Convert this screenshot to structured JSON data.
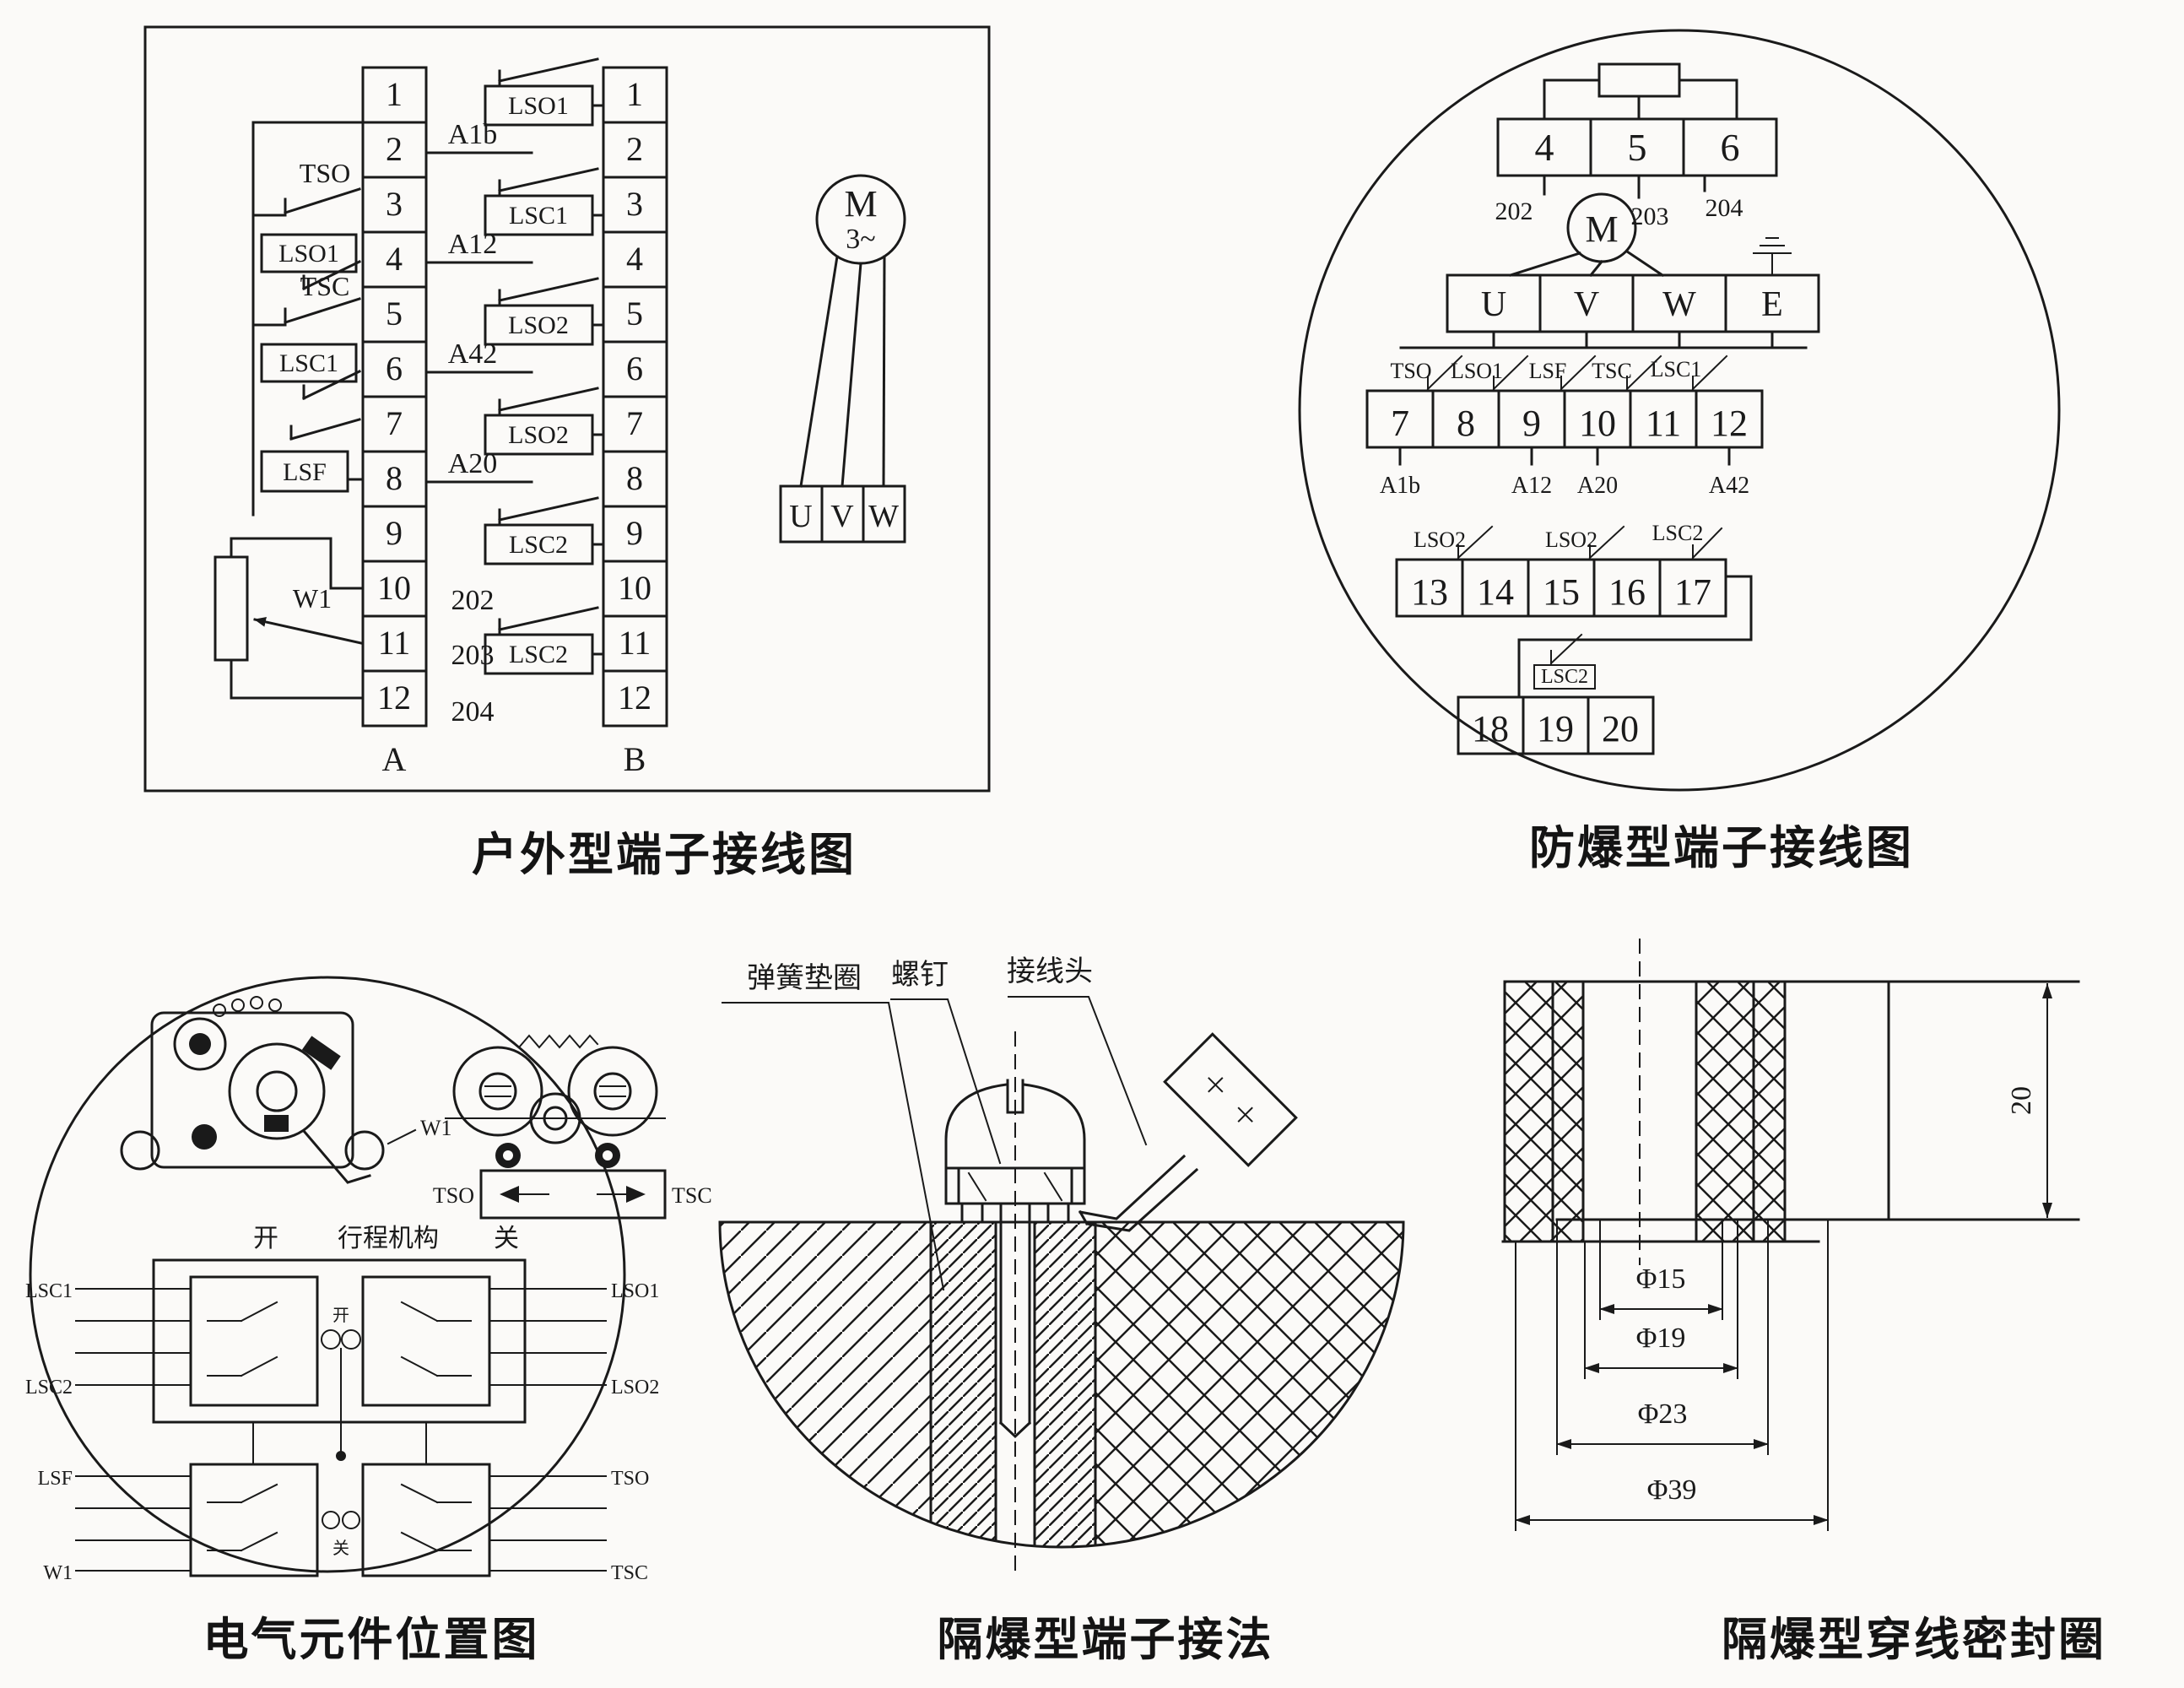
{
  "ink": "#1a1a1a",
  "bg": "#fbfaf8",
  "captions": {
    "outdoor": "户外型端子接线图",
    "explosion": "防爆型端子接线图",
    "components": "电气元件位置图",
    "terminal_method": "隔爆型端子接法",
    "seal_ring": "隔爆型穿线密封圈"
  },
  "outdoor": {
    "terminals": [
      "1",
      "2",
      "3",
      "4",
      "5",
      "6",
      "7",
      "8",
      "9",
      "10",
      "11",
      "12"
    ],
    "strip_a_label": "A",
    "strip_b_label": "B",
    "left_switches": {
      "tso": "TSO",
      "lso1": "LSO1",
      "tsc": "TSC",
      "lsc1": "LSC1",
      "lsf": "LSF"
    },
    "pot": "W1",
    "right_labels": {
      "a1b": "A1b",
      "a12": "A12",
      "a42": "A42",
      "a20": "A20",
      "n202": "202",
      "n203": "203",
      "n204": "204"
    },
    "b_switches": [
      "LSO1",
      "LSC1",
      "LSO2",
      "LSO2",
      "LSC2",
      "LSC2"
    ],
    "motor": {
      "m": "M",
      "phase": "3~",
      "u": "U",
      "v": "V",
      "w": "W"
    }
  },
  "explosion": {
    "row1": [
      "4",
      "5",
      "6"
    ],
    "row1_sub": [
      "202",
      "203",
      "204"
    ],
    "motor_m": "M",
    "row2": [
      "U",
      "V",
      "W",
      "E"
    ],
    "row3": [
      "7",
      "8",
      "9",
      "10",
      "11",
      "12"
    ],
    "row3_switches": [
      "TSO",
      "LSO1",
      "LSF",
      "TSC",
      "LSC1"
    ],
    "row3_sub": [
      "A1b",
      "A12",
      "A20",
      "A42"
    ],
    "row4": [
      "13",
      "14",
      "15",
      "16",
      "17"
    ],
    "row4_switches": [
      "LSO2",
      "LSO2",
      "LSC2"
    ],
    "row5": [
      "18",
      "19",
      "20"
    ],
    "row5_switch": "LSC2"
  },
  "components": {
    "pot_label": "W1",
    "torque_left": "TSO",
    "torque_right": "TSC",
    "row_open": "开",
    "row_mech": "行程机构",
    "row_close": "关",
    "g1_l1": "LSC1",
    "g1_l2": "LSC2",
    "g1_r1": "LSO1",
    "g1_r2": "LSO2",
    "g1_c": "开",
    "g2_l1": "LSF",
    "g2_l2": "W1",
    "g2_r1": "TSO",
    "g2_r2": "TSC",
    "g2_c": "关"
  },
  "method": {
    "washer": "弹簧垫圈",
    "screw": "螺钉",
    "lug": "接线头"
  },
  "seal": {
    "h": "20",
    "d1": "Φ15",
    "d2": "Φ19",
    "d3": "Φ23",
    "d4": "Φ39"
  }
}
